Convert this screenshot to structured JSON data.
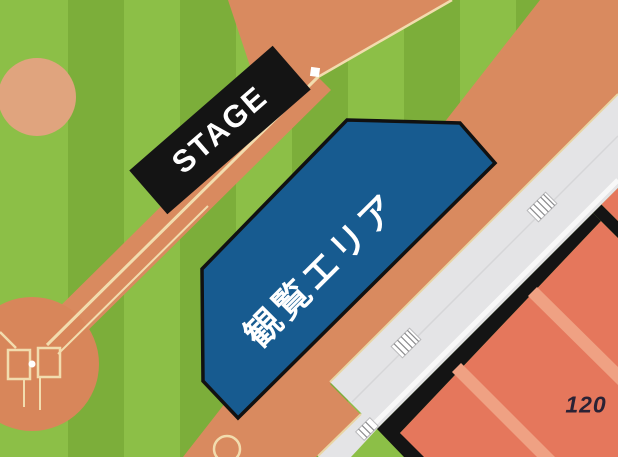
{
  "map": {
    "name": "stadium-event-map",
    "labels": {
      "stage": "STAGE",
      "viewing_area": "観覧エリア",
      "section": "120"
    }
  },
  "colors": {
    "grass_light": "#8cbf47",
    "grass_dark": "#7cae3a",
    "dirt": "#d98a5f",
    "dirt_circle_light": "#e0a47e",
    "home_plate_dirt": "#d8865a",
    "chalk_line": "#f2dcae",
    "viewing_area_blue": "#175b90",
    "outline_black": "#141414",
    "walkway_gray": "#e4e4e6",
    "walkway_highlight": "#f8f8f8",
    "seating_red": "#e5775c",
    "seating_aisle": "#efa183",
    "section_label_dark": "#2a2235",
    "label_white": "#ffffff"
  }
}
